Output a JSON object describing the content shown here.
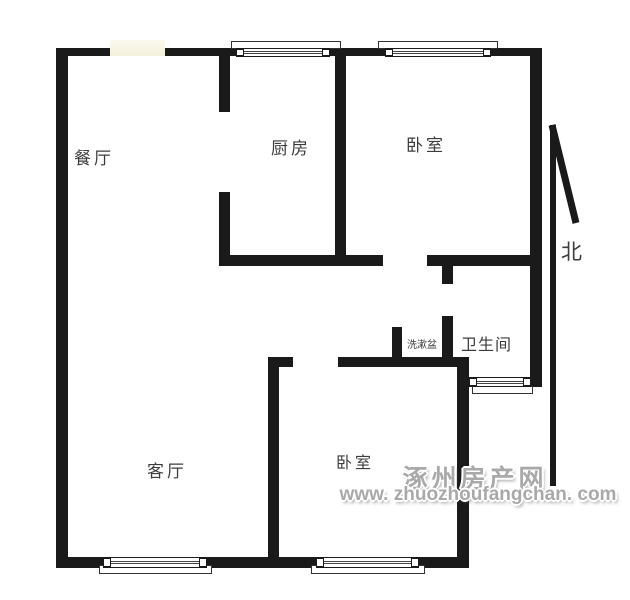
{
  "colors": {
    "wall": "#1a1a1a",
    "label": "#3c3c3c",
    "watermark": "#a9a9a9",
    "window-accent": "#f5f2de"
  },
  "rooms": {
    "dining": {
      "label": "餐厅"
    },
    "kitchen": {
      "label": "厨房"
    },
    "bedroom_top": {
      "label": "卧室"
    },
    "bathroom": {
      "label": "卫生间"
    },
    "washbasin": {
      "label": "洗漱盆"
    },
    "living": {
      "label": "客厅"
    },
    "bedroom_bottom": {
      "label": "卧室"
    }
  },
  "compass": {
    "north_label": "北"
  },
  "watermark": {
    "site_name": "涿州房产网",
    "site_url": "www. zhuozhoufangchan. com"
  }
}
